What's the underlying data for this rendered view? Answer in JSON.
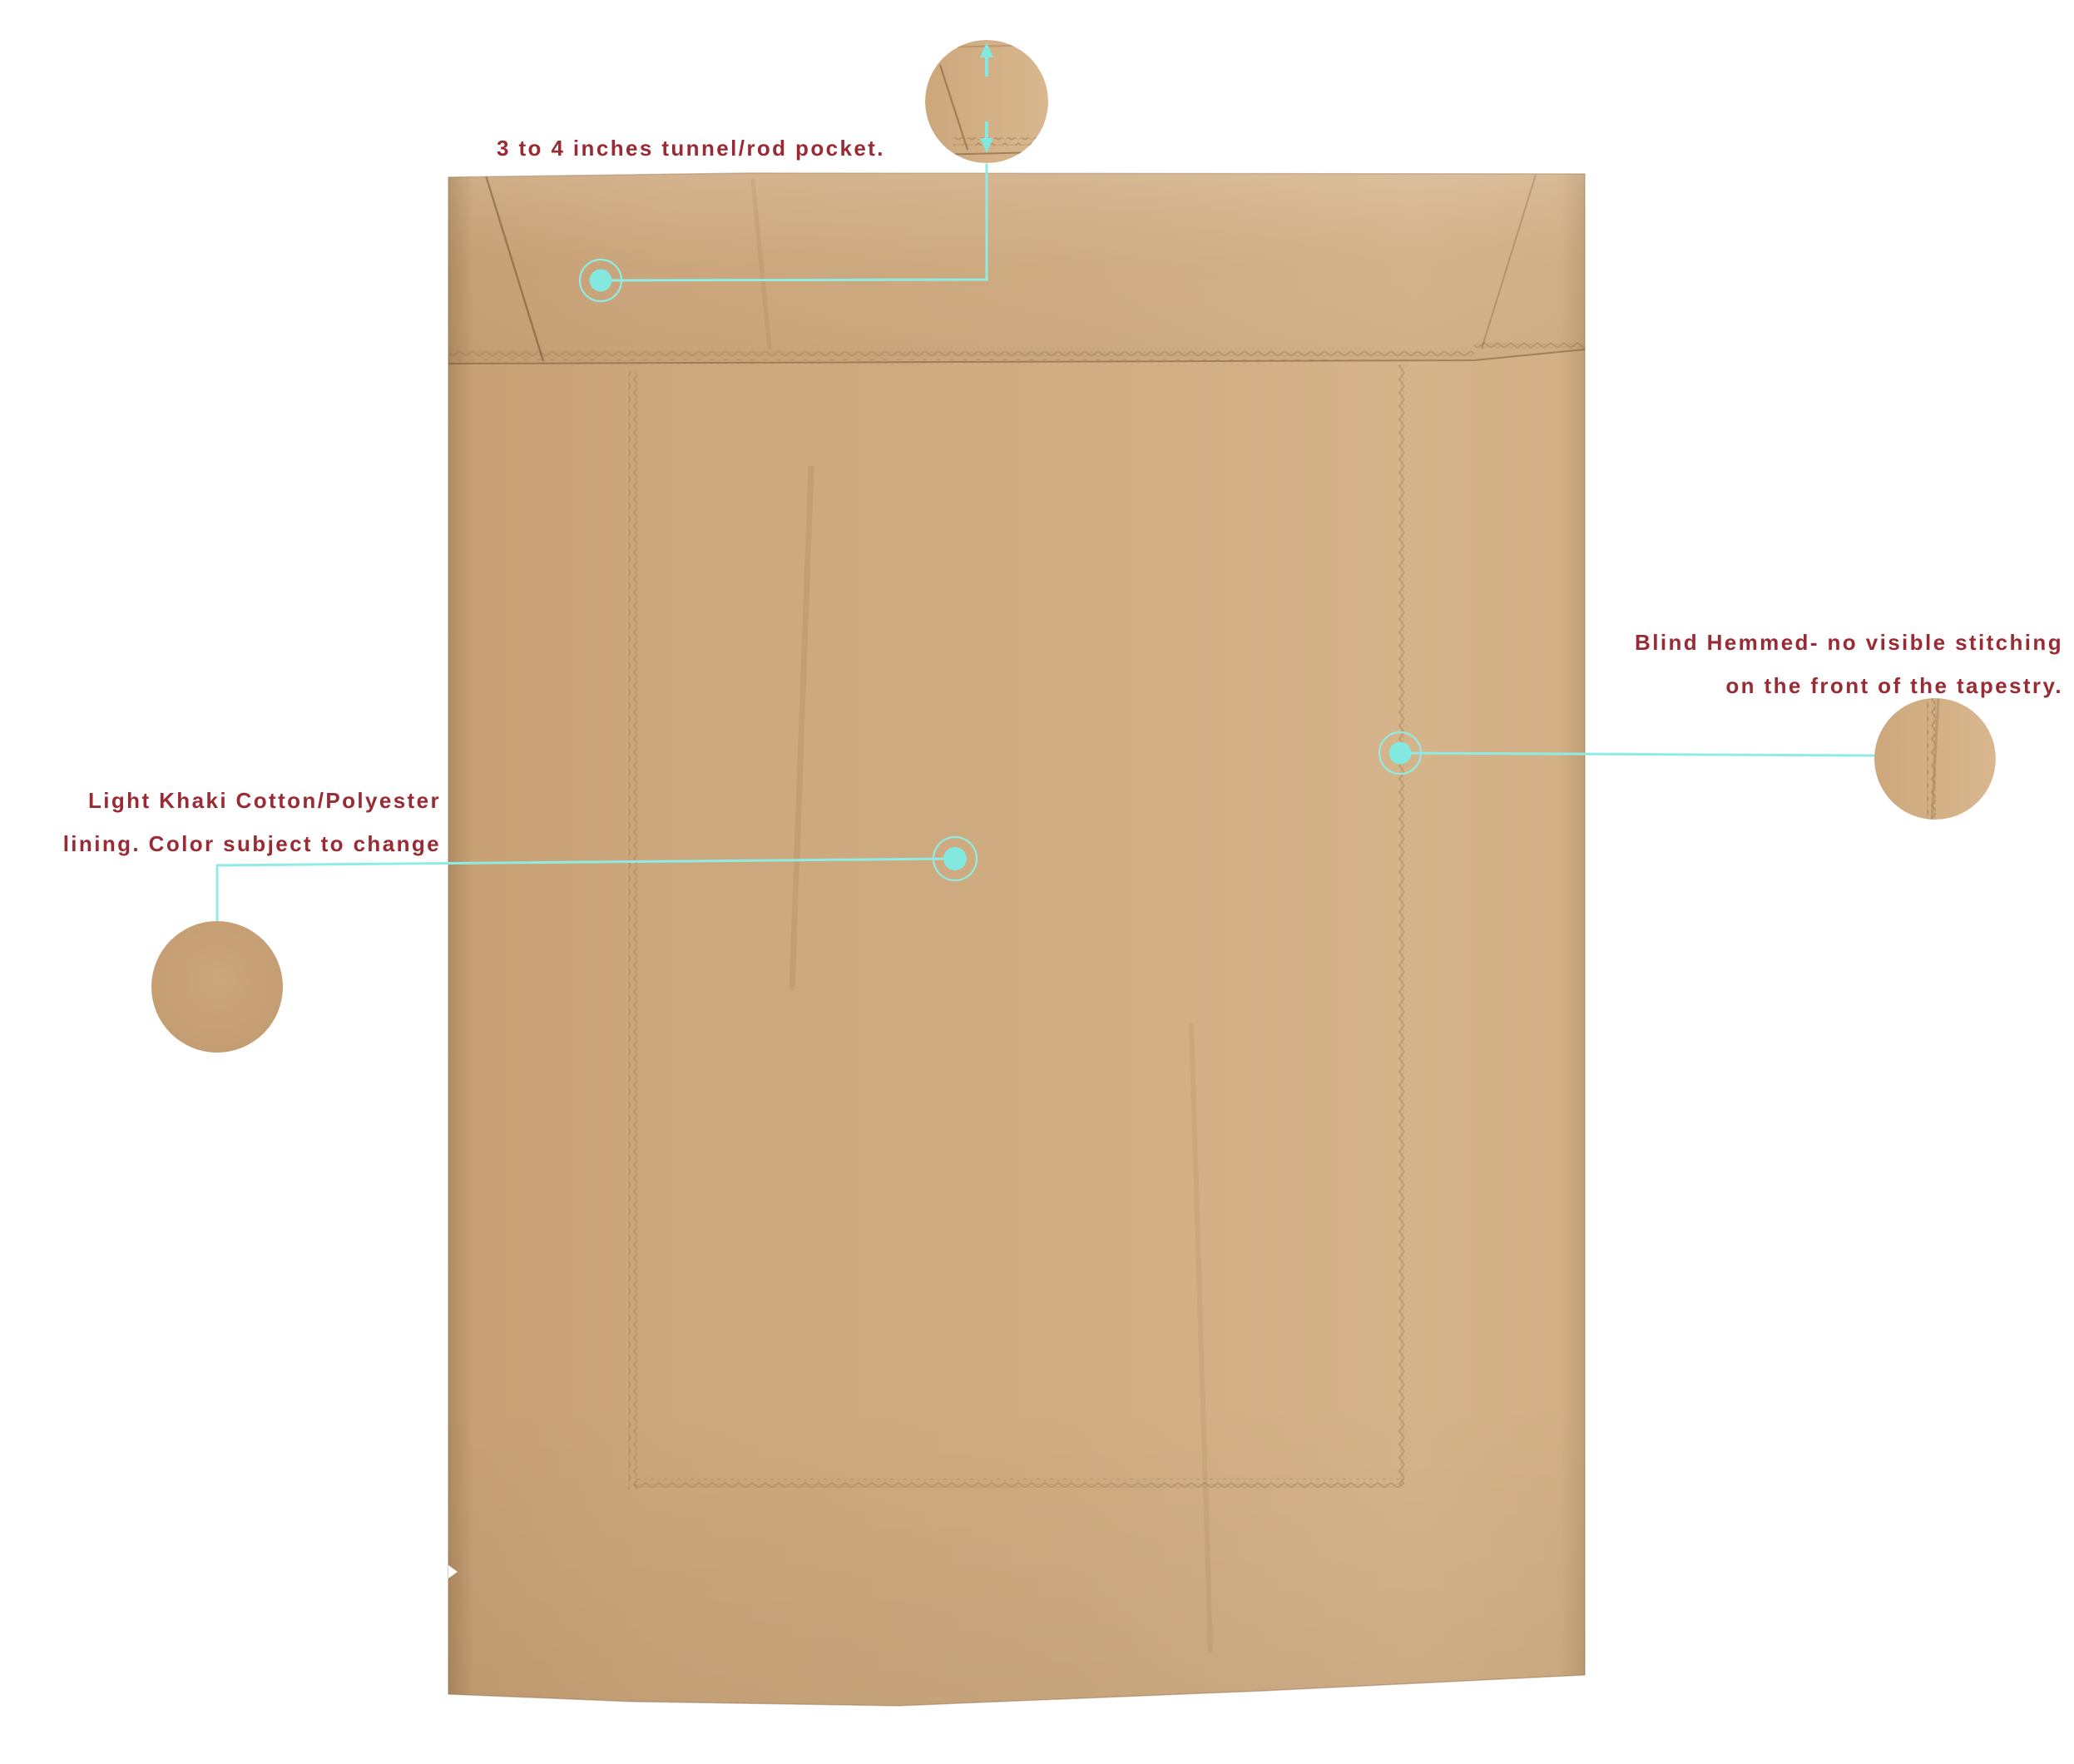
{
  "colors": {
    "bg": "#ffffff",
    "accent": "#82e8e0",
    "accent_line": "#8fece5",
    "label": "#9a2a33",
    "fabric": "#d0ac82",
    "fabric_dark": "#c7a074",
    "fabric_light": "#d6b48b",
    "stitch": "#a98a63",
    "crease": "#6e5030"
  },
  "annotations": {
    "rod_pocket": {
      "label": "3 to 4 inches tunnel/rod pocket."
    },
    "lining": {
      "line1": "Light Khaki Cotton/Polyester",
      "line2": "lining. Color subject to change"
    },
    "blind_hem": {
      "line1": "Blind Hemmed- no visible stitching",
      "line2": "on the front of the tapestry."
    }
  }
}
